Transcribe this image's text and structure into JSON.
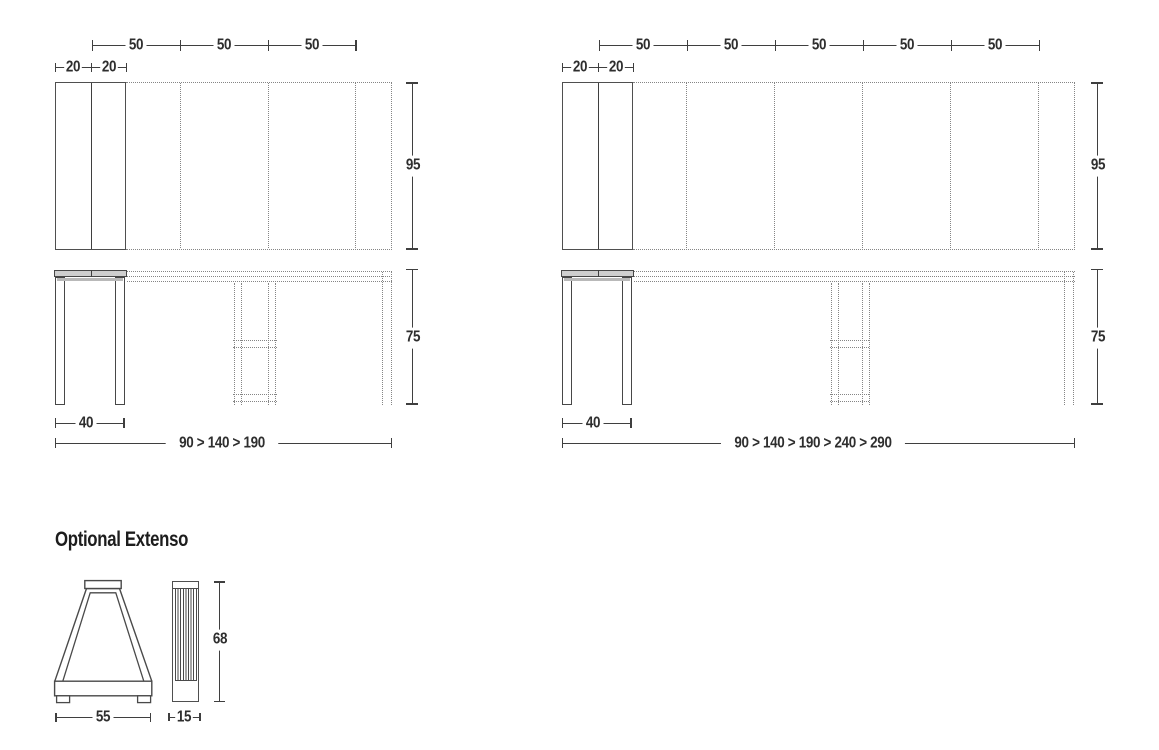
{
  "colors": {
    "line": "#3f3f3f",
    "dotted": "#858585",
    "text": "#2e2e2e",
    "tabletop_fill": "#cfcfcf",
    "background": "#ffffff"
  },
  "table_190": {
    "segments": [
      "50",
      "50",
      "50"
    ],
    "leaves": [
      "20",
      "20"
    ],
    "depth_cm": "95",
    "height_cm": "75",
    "base_width_cm": "40",
    "lengths_cm": "90 > 140 > 190"
  },
  "table_290": {
    "segments": [
      "50",
      "50",
      "50",
      "50",
      "50"
    ],
    "leaves": [
      "20",
      "20"
    ],
    "depth_cm": "95",
    "height_cm": "75",
    "base_width_cm": "40",
    "lengths_cm": "90 > 140 > 190 > 240 > 290"
  },
  "extenso": {
    "title": "Optional Extenso",
    "width_cm": "55",
    "depth_cm": "15",
    "height_cm": "68"
  }
}
